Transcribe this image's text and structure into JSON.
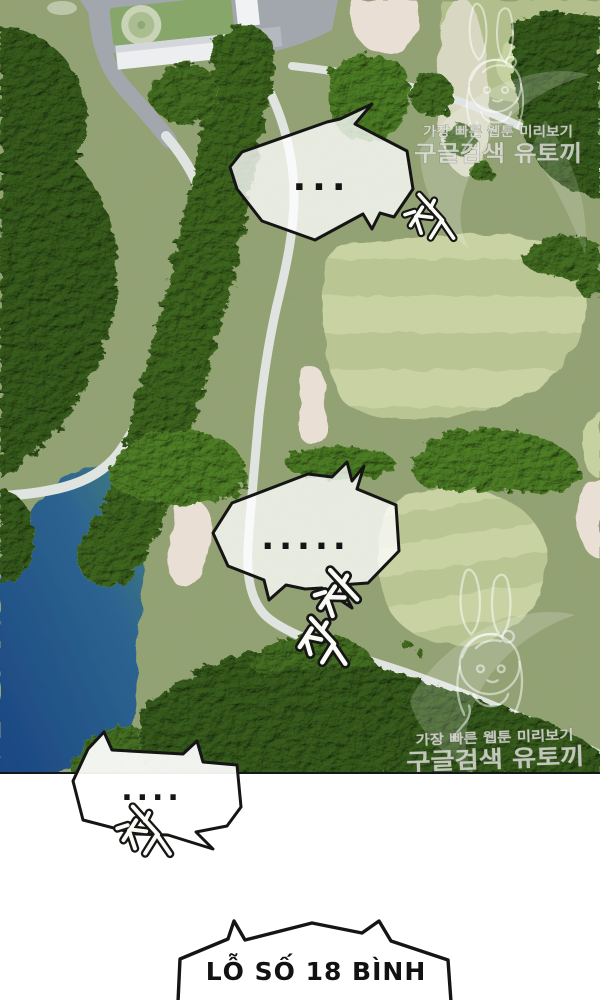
{
  "panel": {
    "bubbles": [
      {
        "text": "..."
      },
      {
        "text": "....."
      },
      {
        "text": "...."
      },
      {
        "text": "LỖ SỐ 18 BÌNH"
      }
    ],
    "sfx": [
      {
        "text": "척"
      },
      {
        "text": "처적"
      },
      {
        "text": "척"
      }
    ],
    "watermark": {
      "line1": "가장 빠른 웹툰 미리보기",
      "line2": "구글검색 유토끼"
    }
  },
  "scene": {
    "colors": {
      "rough": "#93a274",
      "fairway_light": "#c8d2a2",
      "fairway_dark": "#b9c593",
      "fairway_tr": "#b2bf8c",
      "fairway_tr_light": "#c6d1a0",
      "green_pale": "#d8d8c2",
      "bunker": "#e9dfd4",
      "lake_teal": "#4b8476",
      "lake_mid": "#2d6590",
      "lake_deep": "#1b4682",
      "cart_path": "#e0e4e0",
      "road": "#a2a7ae",
      "forest_dark": "#4c6a34",
      "forest_mid": "#5d7f3f",
      "forest_light": "#6f9549",
      "photo_edge": "#15181a",
      "bubble_border": "#151515",
      "sfx_outline": "#161616",
      "sfx_fill": "#fbfbf6"
    }
  }
}
